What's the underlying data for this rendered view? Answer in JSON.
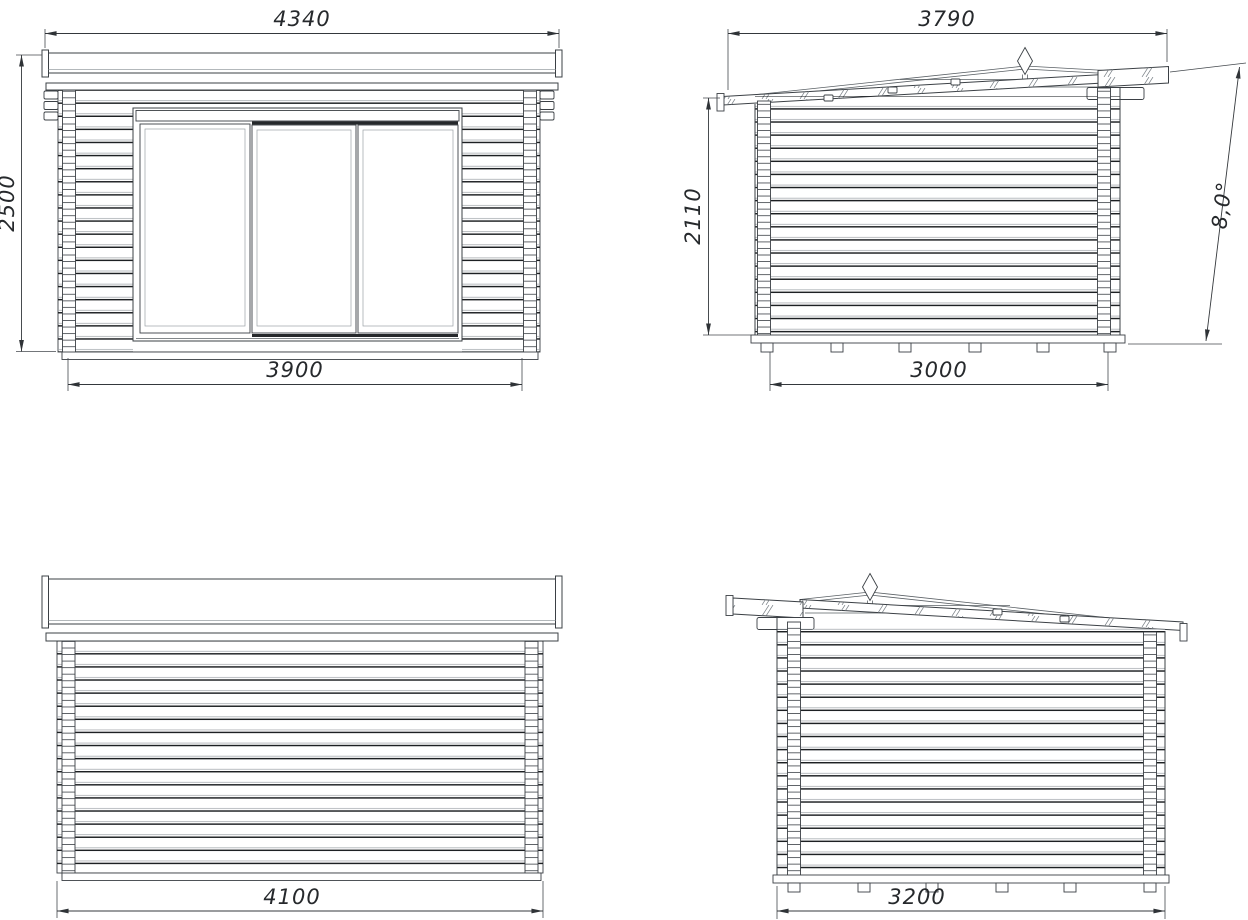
{
  "drawing": {
    "sheet": "garden-house-elevation-drawings",
    "background_color": "#ffffff",
    "line_color": "#3b4045",
    "views": {
      "front_elevation": {
        "features": [
          "flat fascia roof edge",
          "three-panel sliding glass door",
          "log wall",
          "corner joint posts"
        ],
        "dimensions": {
          "roof_width_mm": "4340",
          "height_mm": "2500",
          "base_width_mm": "3900"
        }
      },
      "right_side_elevation": {
        "features": [
          "gable roof with finial",
          "log wall",
          "corner joint posts",
          "foundation blocks"
        ],
        "dimensions": {
          "roof_width_mm": "3790",
          "wall_height_mm": "2110",
          "roof_pitch_deg": "8,0°",
          "base_width_mm": "3000"
        }
      },
      "rear_elevation": {
        "features": [
          "flat fascia roof edge",
          "plain log wall",
          "corner joint posts"
        ],
        "dimensions": {
          "base_width_mm": "4100"
        }
      },
      "left_side_elevation": {
        "features": [
          "gable roof with finial",
          "log wall",
          "corner joint posts",
          "foundation blocks"
        ],
        "dimensions": {
          "base_width_mm": "3200"
        }
      }
    }
  }
}
